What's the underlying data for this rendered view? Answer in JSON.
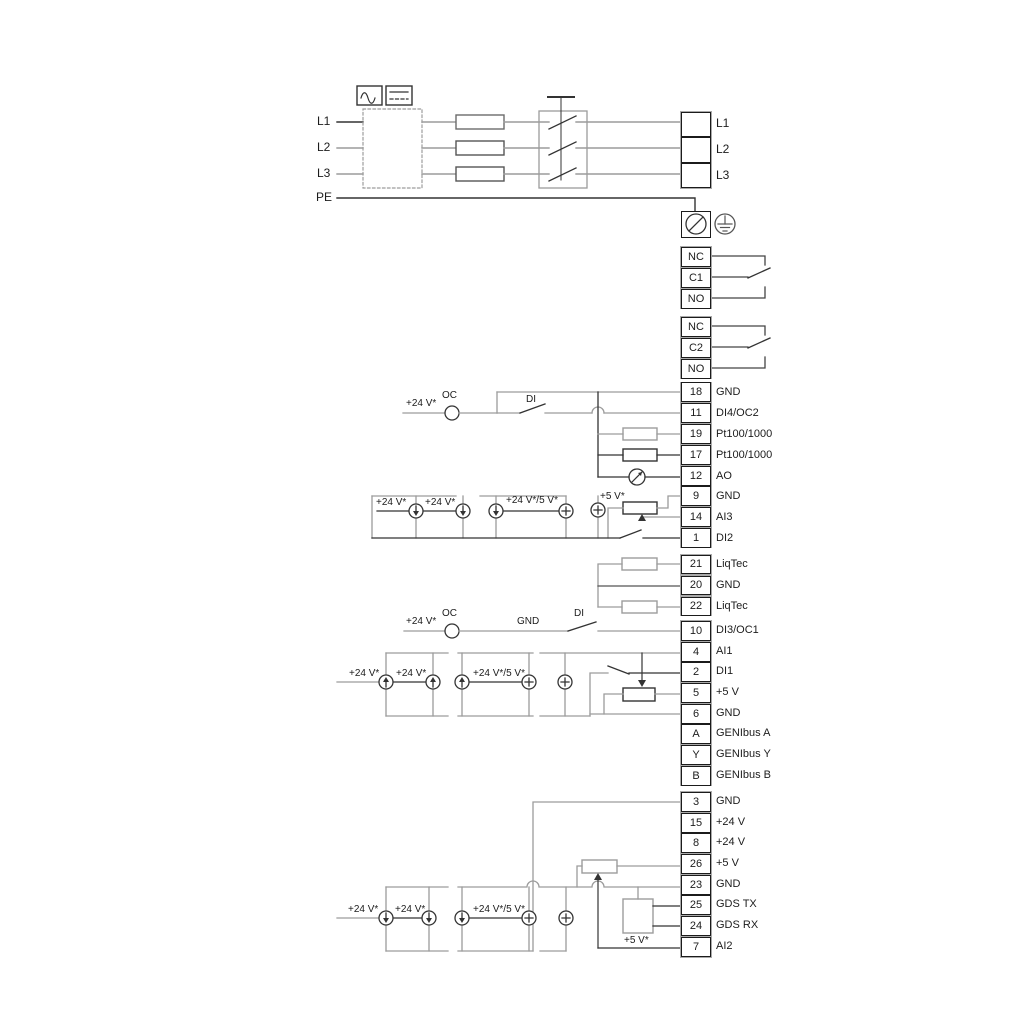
{
  "d": {
    "power_in": {
      "l1": "L1",
      "l2": "L2",
      "l3": "L3",
      "pe": "PE"
    },
    "power_out": {
      "l1": "L1",
      "l2": "L2",
      "l3": "L3"
    },
    "relay1": {
      "top": "NC",
      "mid": "C1",
      "bot": "NO"
    },
    "relay2": {
      "top": "NC",
      "mid": "C2",
      "bot": "NO"
    },
    "blockA": [
      {
        "num": "18",
        "label": "GND"
      },
      {
        "num": "11",
        "label": "DI4/OC2"
      },
      {
        "num": "19",
        "label": "Pt100/1000"
      },
      {
        "num": "17",
        "label": "Pt100/1000"
      },
      {
        "num": "12",
        "label": "AO"
      },
      {
        "num": "9",
        "label": "GND"
      },
      {
        "num": "14",
        "label": "AI3"
      },
      {
        "num": "1",
        "label": "DI2"
      }
    ],
    "liqtec": [
      {
        "num": "21",
        "label": "LiqTec"
      },
      {
        "num": "20",
        "label": "GND"
      },
      {
        "num": "22",
        "label": "LiqTec"
      }
    ],
    "blockB": [
      {
        "num": "10",
        "label": "DI3/OC1"
      },
      {
        "num": "4",
        "label": "AI1"
      },
      {
        "num": "2",
        "label": "DI1"
      },
      {
        "num": "5",
        "label": "+5 V"
      },
      {
        "num": "6",
        "label": "GND"
      },
      {
        "num": "A",
        "label": "GENIbus A"
      },
      {
        "num": "Y",
        "label": "GENIbus Y"
      },
      {
        "num": "B",
        "label": "GENIbus B"
      }
    ],
    "blockC": [
      {
        "num": "3",
        "label": "GND"
      },
      {
        "num": "15",
        "label": "+24 V"
      },
      {
        "num": "8",
        "label": "+24 V"
      },
      {
        "num": "26",
        "label": "+5 V"
      },
      {
        "num": "23",
        "label": "GND"
      },
      {
        "num": "25",
        "label": "GDS TX"
      },
      {
        "num": "24",
        "label": "GDS RX"
      },
      {
        "num": "7",
        "label": "AI2"
      }
    ],
    "ann": {
      "di4": {
        "supply": "+24 V*",
        "oc": "OC",
        "di": "DI"
      },
      "ai3": {
        "s1": "+24 V*",
        "s2": "+24 V*",
        "s3": "+24 V*/5 V*",
        "s4": "+5 V*"
      },
      "di3": {
        "supply": "+24 V*",
        "oc": "OC",
        "gnd": "GND",
        "di": "DI"
      },
      "ai1": {
        "s1": "+24 V*",
        "s2": "+24 V*",
        "s3": "+24 V*/5 V*"
      },
      "ai2": {
        "s1": "+24 V*",
        "s2": "+24 V*",
        "s3": "+24 V*/5 V*",
        "s4": "+5 V*"
      }
    },
    "icons": {
      "ac": "ac-waveform-icon",
      "dc": "dc-icon",
      "shield": "cable-shield-terminal-icon",
      "earth": "protective-earth-icon",
      "meter": "analog-output-meter-icon"
    },
    "colors": {
      "line_grey": "#9c9c9c",
      "line_dark": "#333333",
      "text": "#1c1c1c",
      "bg": "#ffffff"
    }
  }
}
